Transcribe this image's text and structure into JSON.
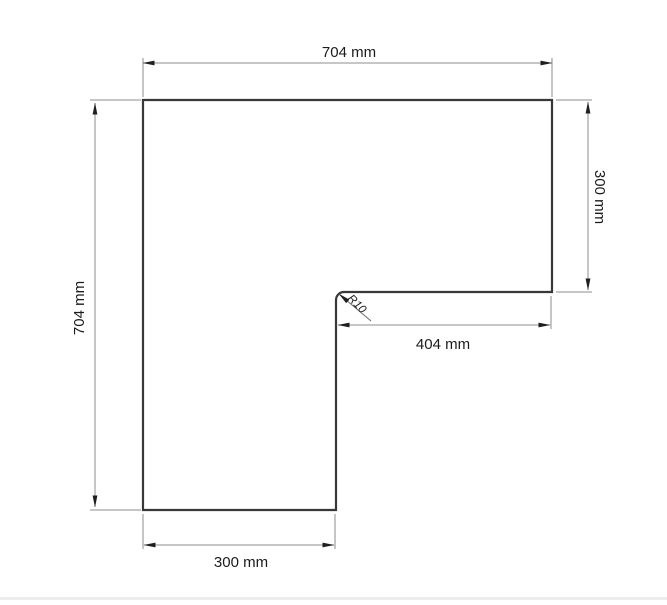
{
  "drawing": {
    "labels": {
      "top": "704 mm",
      "right": "300 mm",
      "inner": "404 mm",
      "bottom": "300 mm",
      "left": "704 mm",
      "radius": "R10"
    },
    "values_mm": {
      "overall_width": 704,
      "overall_height": 704,
      "right_leg_depth": 300,
      "inner_edge_width": 404,
      "bottom_leg_width": 300,
      "inner_corner_radius": 10
    },
    "colors": {
      "background": "#ffffff",
      "outline": "#383838",
      "dimension": "#8c8c8c",
      "leader": "#6a6a6a",
      "arrow": "#1f1f1f",
      "text": "#1b1b1b",
      "bottom_strip": "#ededed"
    }
  }
}
